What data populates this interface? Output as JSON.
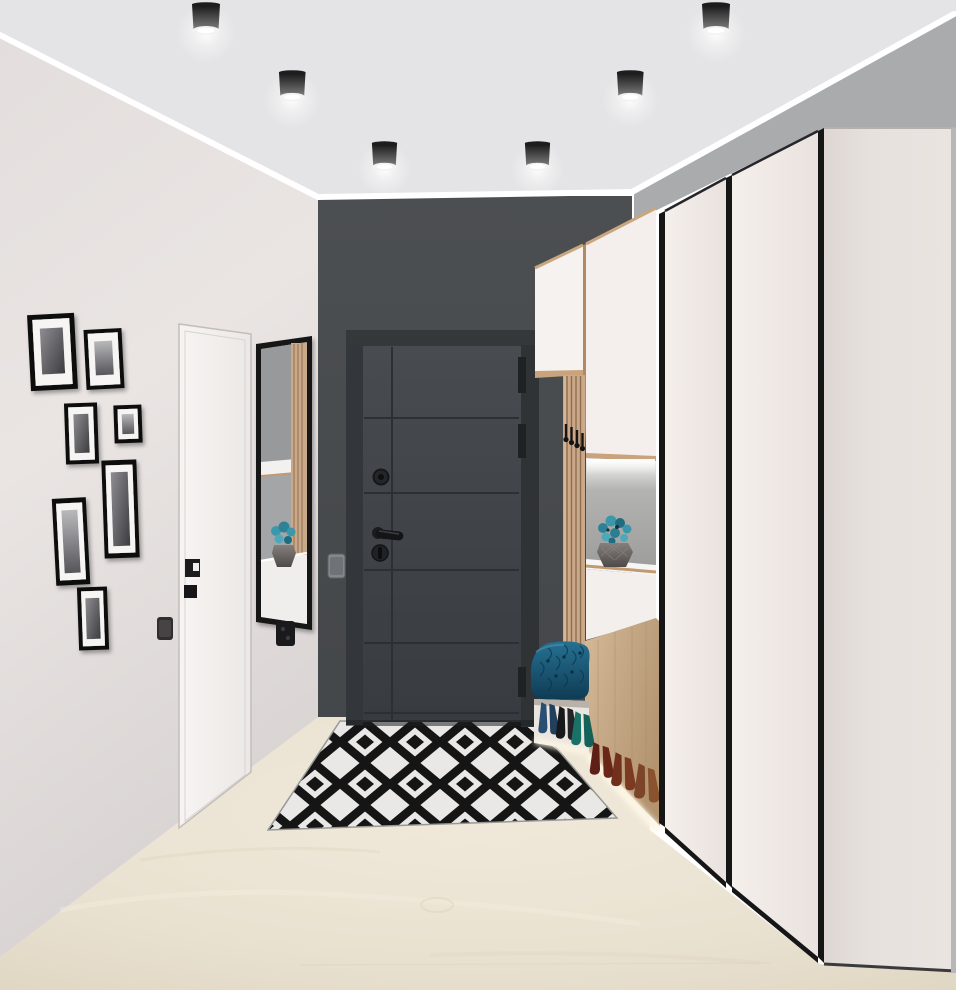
{
  "scene": {
    "label": "modern entryway hallway interior render",
    "width_px": 956,
    "height_px": 990
  },
  "colors": {
    "ceiling": "#e4e3e5",
    "trim": "#ffffff",
    "left_wall": "#e7e2e0",
    "back_wall": "#494c4f",
    "right_wall": "#a9abad",
    "floor": "#e9e1d1",
    "rug_black": "#161616",
    "rug_white": "#f3f2f0",
    "entry_door": "#42464a",
    "entry_door_frame": "#34373a",
    "interior_door": "#f4f1ef",
    "mirror_frame": "#151515",
    "wardrobe_face": "#f2ece8",
    "wardrobe_trim": "#161616",
    "wardrobe_panel": "#e4dedb",
    "wood": "#c9ab87",
    "niche_back": "#a6a6a4",
    "glow": "#fff6e4",
    "cushion": "#1c5a7a",
    "flower": "#3d97ab",
    "vase": "#6e6a68",
    "photo_frame": "#111111",
    "switch_dark": "#2f2d2e",
    "switch_grey": "#84878b"
  },
  "ceiling": {
    "label": "light grey ceiling with six black cylinder spotlights",
    "lights_count": 6
  },
  "left_wall": {
    "label": "warm white wall",
    "gallery": {
      "label": "gallery wall of seven black-framed black and white photos",
      "frames_count": 7
    },
    "interior_door": {
      "label": "white flush interior door",
      "handle_label": "black flush pull with lock"
    },
    "switch_label": "dark wall switch",
    "mirror": {
      "label": "full length mirror in thin black frame",
      "reflection_label": "reflection of oak slats, shelf and vase with teal flowers"
    },
    "socket_label": "black double socket"
  },
  "back_wall": {
    "label": "graphite accent wall",
    "entry_door": {
      "label": "charcoal entrance door with horizontal grooves",
      "grooves": 5,
      "hinges": 3,
      "peephole": true,
      "handle_label": "black lever handle",
      "lock_label": "cylinder thumb turn"
    },
    "switch_label": "grey light switch"
  },
  "hallway_unit": {
    "label": "hallway storage unit",
    "upper_cabinets_count": 2,
    "coat_rack": {
      "label": "oak slat coat rack",
      "hooks_count": 4
    },
    "niche": {
      "label": "backlit display niche",
      "vase_label": "faceted grey vase with teal flowers"
    },
    "bench": {
      "label": "bench with navy tufted velvet cushion"
    },
    "shoe_shelves": {
      "label": "open backlit shoe shelves",
      "rows": 2,
      "row1": [
        "navy heels",
        "black heels",
        "teal heels"
      ],
      "row2": [
        "oxblood shoes",
        "burgundy shoes",
        "brown shoes"
      ]
    }
  },
  "wardrobe": {
    "label": "floor to ceiling white wardrobe with black edge trim",
    "visible_doors": 3,
    "side_panel_label": "flat cream return panel"
  },
  "floor": {
    "label": "light oak laminate floor"
  },
  "rug": {
    "label": "black and white diamond pattern rug"
  }
}
